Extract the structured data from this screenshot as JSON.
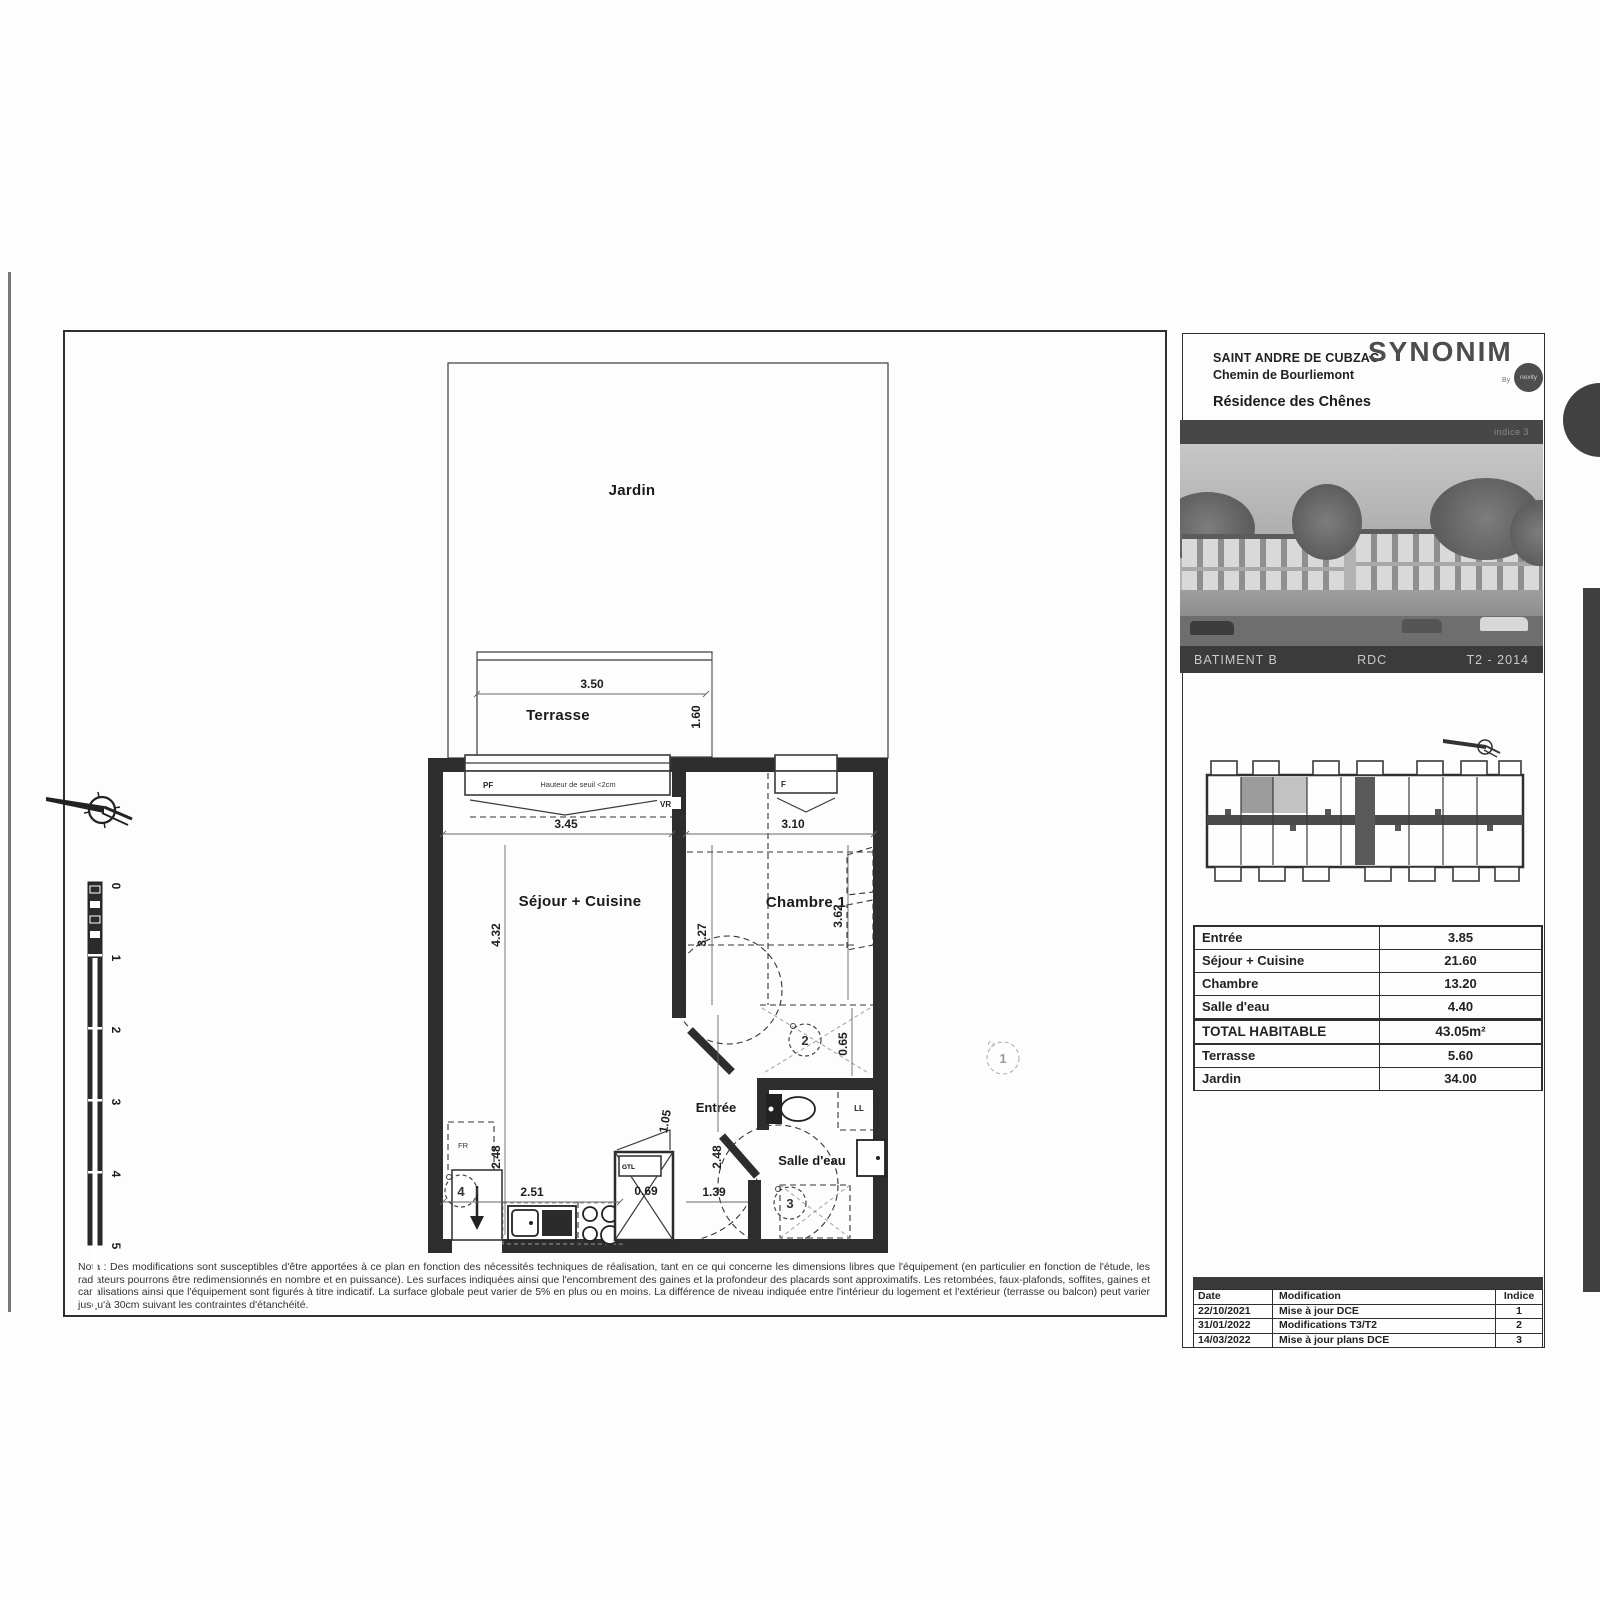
{
  "header": {
    "city": "SAINT ANDRE DE CUBZAC",
    "street": "Chemin de Bourliemont",
    "brand": "SYNONIM",
    "by": "By",
    "brand_sub": "nexity",
    "residence": "Résidence des Chênes"
  },
  "photo": {
    "overlay": "indice 3",
    "batiment": "BATIMENT B",
    "level": "RDC",
    "unit": "T2 - 2014"
  },
  "area_table": {
    "rows": [
      {
        "label": "Entrée",
        "value": "3.85"
      },
      {
        "label": "Séjour + Cuisine",
        "value": "21.60"
      },
      {
        "label": "Chambre",
        "value": "13.20"
      },
      {
        "label": "Salle d'eau",
        "value": "4.40"
      },
      {
        "label": "TOTAL HABITABLE",
        "value": "43.05m²"
      },
      {
        "label": "Terrasse",
        "value": "5.60"
      },
      {
        "label": "Jardin",
        "value": "34.00"
      }
    ]
  },
  "revision_table": {
    "headers": [
      "Date",
      "Modification",
      "Indice"
    ],
    "rows": [
      [
        "22/10/2021",
        "Mise à jour DCE",
        "1"
      ],
      [
        "31/01/2022",
        "Modifications T3/T2",
        "2"
      ],
      [
        "14/03/2022",
        "Mise à jour plans DCE",
        "3"
      ]
    ]
  },
  "note": {
    "text": "Nota : Des modifications sont susceptibles d'être apportées à ce plan en fonction des nécessités techniques de réalisation, tant en ce qui concerne les dimensions libres que l'équipement (en particulier en fonction de l'étude, les radiateurs pourrons être redimensionnés en nombre et en puissance). Les surfaces indiquées ainsi que l'encombrement des gaines et la profondeur des placards sont approximatifs. Les retombées, faux-plafonds, soffites, gaines et canalisations ainsi que l'équipement sont figurés à titre indicatif. La surface globale peut varier de 5% en plus ou en moins. La différence de niveau indiquée entre l'intérieur du logement et l'extérieur (terrasse ou balcon) peut varier jusqu'à 30cm suivant les contraintes d'étanchéité."
  },
  "plan": {
    "rooms": {
      "jardin": "Jardin",
      "terrasse": "Terrasse",
      "sejour": "Séjour + Cuisine",
      "chambre": "Chambre 1",
      "entree": "Entrée",
      "salle_deau": "Salle d'eau"
    },
    "dims": {
      "terrasse_w": "3.50",
      "terrasse_d": "1.60",
      "sejour_w": "3.45",
      "chambre_w": "3.10",
      "sejour_h": "4.32",
      "mid_h": "3.27",
      "chambre_h": "3.62",
      "chambre_low": "0.65",
      "left_low": "2.48",
      "kitchen_w": "2.51",
      "gtl_w": "0.69",
      "hall_w": "1.39",
      "hall_h": "2.48",
      "hall_diag": "1.05"
    },
    "tags": {
      "pf": "PF",
      "seuil": "Hauteur de seuil <2cm",
      "vr": "VR",
      "f": "F",
      "fr": "FR",
      "gtl": "GTL",
      "ll": "LL"
    },
    "markers": {
      "m1": "1",
      "m2": "2",
      "m3": "3",
      "m4": "4"
    },
    "scale": [
      "0",
      "1",
      "2",
      "3",
      "4",
      "5"
    ]
  }
}
